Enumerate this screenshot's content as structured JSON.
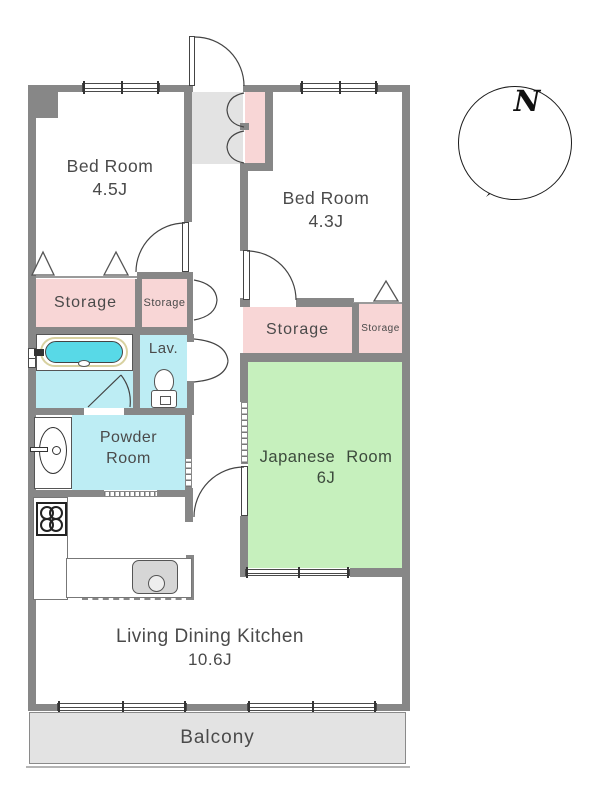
{
  "colors": {
    "wall": "#878787",
    "pink": "#f8d6d6",
    "cyan": "#bdedf4",
    "water": "#58d9e7",
    "green": "#c6f0bd",
    "gray": "#e3e3e3",
    "text": "#4a4a4a"
  },
  "compass": {
    "north_label": "N"
  },
  "rooms": {
    "bedroom_west": {
      "name": "Bed Room",
      "area": "4.5J"
    },
    "bedroom_east": {
      "name": "Bed Room",
      "area": "4.3J"
    },
    "storage_west_large": {
      "label": "Storage"
    },
    "storage_west_small": {
      "label": "Storage"
    },
    "storage_east_large": {
      "label": "Storage"
    },
    "storage_east_small": {
      "label": "Storage"
    },
    "lavatory": {
      "label": "Lav."
    },
    "powder_room": {
      "line1": "Powder",
      "line2": "Room"
    },
    "japanese_room": {
      "name": "Japanese Room",
      "area": "6J"
    },
    "living_dining_kitchen": {
      "name": "Living Dining Kitchen",
      "area": "10.6J"
    },
    "balcony": {
      "label": "Balcony"
    }
  }
}
